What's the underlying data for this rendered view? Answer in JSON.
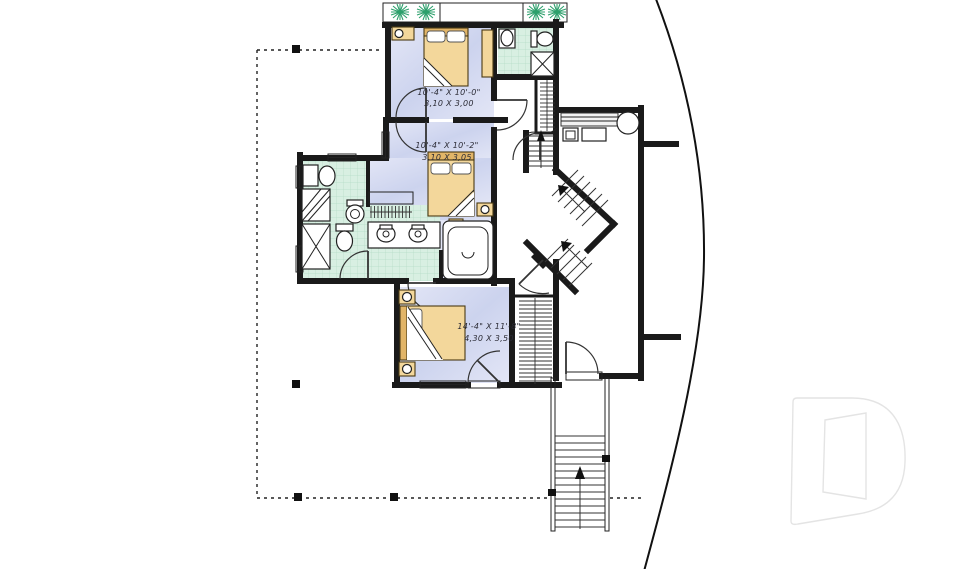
{
  "plan": {
    "type": "house-floor-plan",
    "bedroom_top": {
      "imperial": "10'-4\" X 10'-0\"",
      "metric": "3,10 X 3,00"
    },
    "bedroom_middle": {
      "imperial": "10'-4\" X 10'-2\"",
      "metric": "3,10 X 3,05"
    },
    "bedroom_bottom": {
      "imperial": "14'-4\" X 11'-8\"",
      "metric": "4,30 X 3,50"
    }
  },
  "colors": {
    "wall": "#1a1a1a",
    "bedroom_floor": "#ccd3ee",
    "bedroom_floor_light": "#e3e6f6",
    "bath_floor": "#d8efe2",
    "tile_grid": "#b5dcc6",
    "furniture": "#f3d79b",
    "furniture_dark": "#e2b568",
    "plant": "#2da06c",
    "dim_text": "#2b2b35",
    "watermark": "#e4e4e4"
  },
  "symbols": {
    "watermark": "letter-D-logo",
    "stairs_exterior": "stairs-up-arrow",
    "stairs_interior": "switchback-stairs-up-arrow",
    "deck_boundary": "dashed-deck-outline-with-posts",
    "planters": "deck-planter-with-plants"
  }
}
